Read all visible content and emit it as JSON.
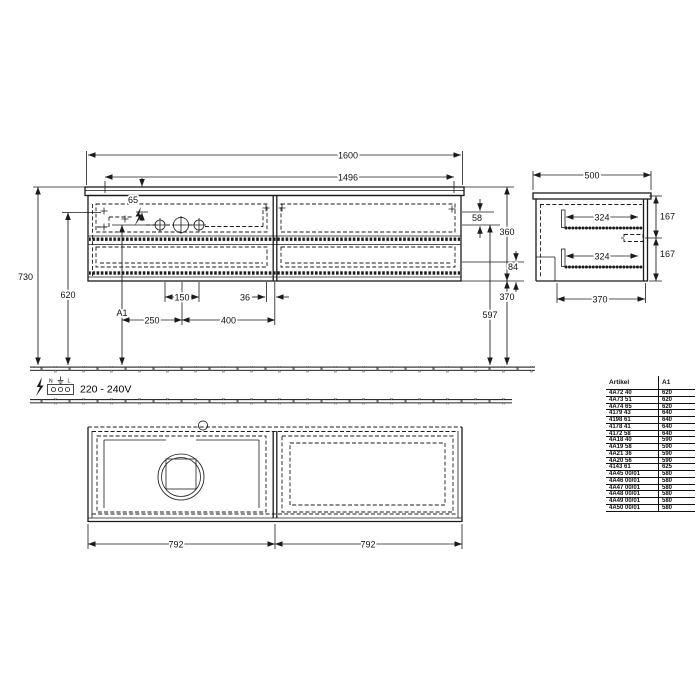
{
  "power": {
    "voltage": "220 - 240V",
    "neutral": "N",
    "line": "L"
  },
  "dims": {
    "front": {
      "total_width": "1600",
      "inner_width": "1496",
      "top_offset": "65",
      "total_height": "730",
      "height_620": "620",
      "height_a1": "A1",
      "hole_gap_58": "58",
      "body_height_360": "360",
      "clearance_370": "370",
      "drain_height_597": "597",
      "offset_84": "84",
      "spacing_250": "250",
      "spacing_150": "150",
      "spacing_400": "400",
      "spacing_36": "36"
    },
    "side": {
      "depth_500": "500",
      "rail_324": "324",
      "gap_167": "167",
      "bottom_370": "370"
    },
    "plan": {
      "half_span": "792"
    }
  },
  "table": {
    "headers": [
      "Artikel",
      "A1"
    ],
    "rows": [
      [
        "4A72 40",
        "620"
      ],
      [
        "4A73 51",
        "620"
      ],
      [
        "4A74 65",
        "620"
      ],
      [
        "4179 43",
        "640"
      ],
      [
        "4198 61",
        "640"
      ],
      [
        "4178 41",
        "640"
      ],
      [
        "4172 58",
        "640"
      ],
      [
        "4A18 40",
        "590"
      ],
      [
        "4A19 58",
        "590"
      ],
      [
        "4A21 36",
        "590"
      ],
      [
        "4A20 56",
        "590"
      ],
      [
        "4143 61",
        "625"
      ],
      [
        "4A45 00/01",
        "580"
      ],
      [
        "4A46 00/01",
        "580"
      ],
      [
        "4A47 00/01",
        "580"
      ],
      [
        "4A48 00/01",
        "580"
      ],
      [
        "4A49 00/01",
        "580"
      ],
      [
        "4A50 00/01",
        "580"
      ]
    ]
  }
}
